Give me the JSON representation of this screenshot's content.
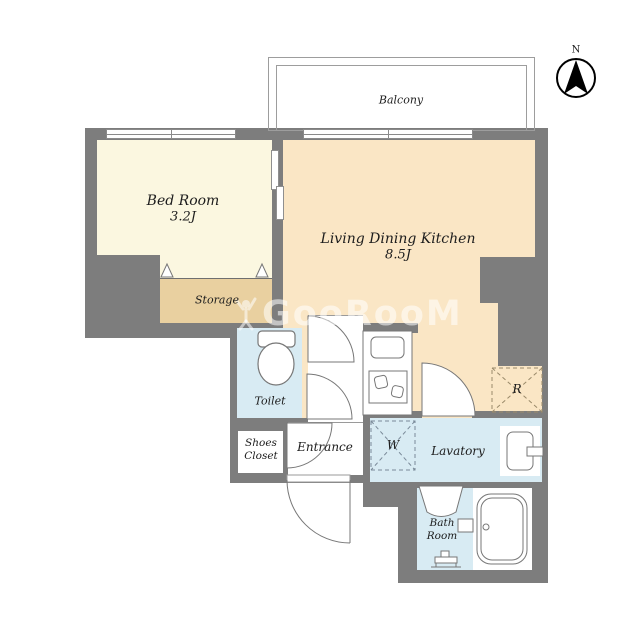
{
  "plan": {
    "title": "1K apartment floor plan",
    "compass": {
      "label": "N"
    },
    "watermark": {
      "text": "GooRooM"
    },
    "rooms": {
      "balcony": {
        "label": "Balcony"
      },
      "bedroom": {
        "label": "Bed Room",
        "area": "3.2J"
      },
      "ldk": {
        "label": "Living Dining Kitchen",
        "area": "8.5J"
      },
      "storage": {
        "label": "Storage"
      },
      "toilet": {
        "label": "Toilet"
      },
      "shoes_closet": {
        "label_line1": "Shoes",
        "label_line2": "Closet"
      },
      "entrance": {
        "label": "Entrance"
      },
      "lavatory": {
        "label": "Lavatory"
      },
      "bathroom": {
        "label_line1": "Bath",
        "label_line2": "Room"
      },
      "washer_space": {
        "label": "W"
      },
      "refrigerator_space": {
        "label": "R"
      }
    },
    "colors": {
      "wall": "#7d7d7d",
      "bedroom_floor": "#fbf7e0",
      "ldk_floor": "#fae6c5",
      "storage_floor": "#e9d0a0",
      "wet_area_floor": "#d8ebf3",
      "line": "#777777"
    }
  }
}
